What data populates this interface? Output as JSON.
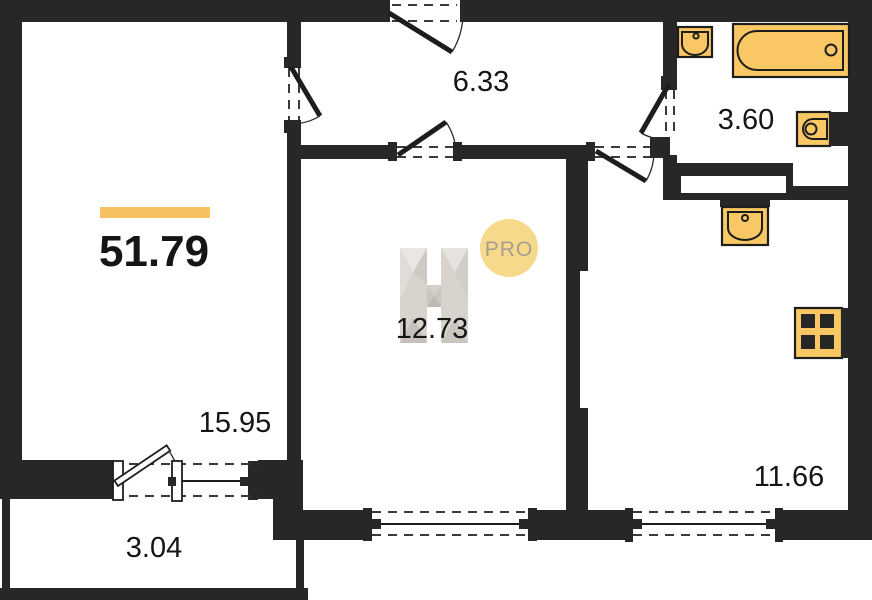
{
  "plan": {
    "title": "apartment floor plan",
    "total_area": "51.79",
    "rooms": [
      {
        "name": "living-room",
        "area": "15.95"
      },
      {
        "name": "hallway",
        "area": "6.33"
      },
      {
        "name": "bathroom",
        "area": "3.60"
      },
      {
        "name": "bedroom",
        "area": "12.73"
      },
      {
        "name": "kitchen",
        "area": "11.66"
      },
      {
        "name": "balcony",
        "area": "3.04"
      }
    ],
    "watermark": {
      "letter": "H",
      "badge": "PRO"
    },
    "fixtures": [
      "washbasin",
      "bathtub",
      "toilet",
      "kitchen-sink",
      "stove"
    ],
    "colors": {
      "wall": "#272727",
      "fixture_fill": "#F9C763",
      "badge_fill": "#F7D98C",
      "accent_bar": "#F5C25F",
      "watermark_gray": "#D8D3CD"
    }
  }
}
